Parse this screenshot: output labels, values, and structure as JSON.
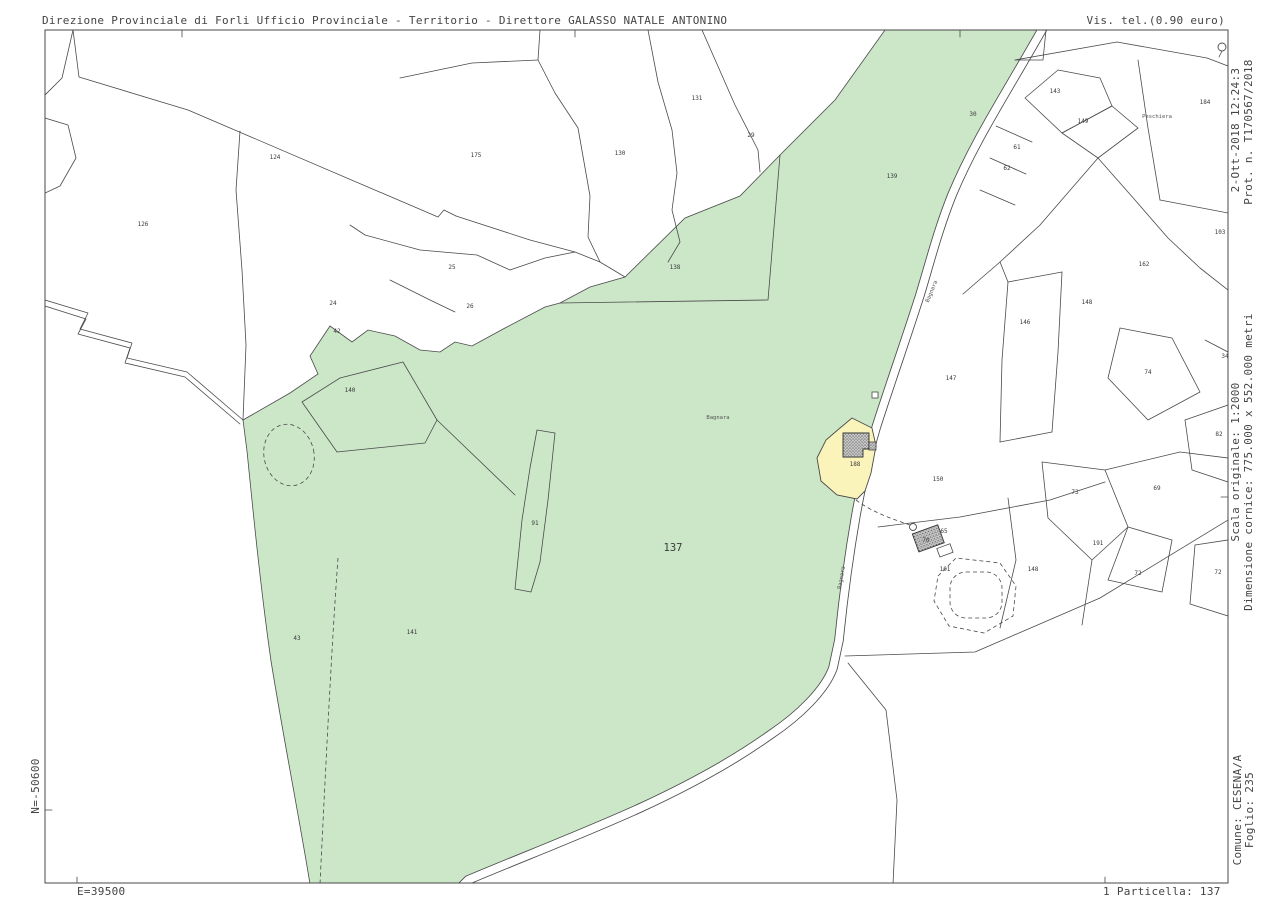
{
  "header": {
    "left": "Direzione Provinciale di Forli  Ufficio Provinciale - Territorio - Direttore GALASSO NATALE ANTONINO",
    "right": "Vis. tel.(0.90 euro)"
  },
  "margins": {
    "right_top_date": "2-Ott-2018 12:24:3",
    "right_top_protocol": "Prot. n. T170567/2018",
    "right_middle_scale": "Scala originale: 1:2000",
    "right_middle_frame": "Dimensione cornice: 775.000 x 552.000 metri",
    "right_bottom_comune": "Comune: CESENA/A",
    "right_bottom_foglio": "Foglio: 235",
    "left_north": "N=-50600",
    "bottom_east": "E=39500",
    "bottom_particella": "1 Particella: 137"
  },
  "map": {
    "selected_parcel": "137",
    "colors": {
      "selected_parcel_green": "#cbe7c8",
      "secondary_parcel_yellow": "#faf4bb",
      "boundary_line": "#4a4a4a",
      "building_fill": "#bdbdbd"
    },
    "labels": [
      {
        "t": "124",
        "x": 275,
        "y": 159
      },
      {
        "t": "126",
        "x": 143,
        "y": 226
      },
      {
        "t": "175",
        "x": 476,
        "y": 157
      },
      {
        "t": "130",
        "x": 620,
        "y": 155
      },
      {
        "t": "131",
        "x": 697,
        "y": 100
      },
      {
        "t": "29",
        "x": 751,
        "y": 137
      },
      {
        "t": "139",
        "x": 892,
        "y": 178
      },
      {
        "t": "138",
        "x": 675,
        "y": 269
      },
      {
        "t": "25",
        "x": 452,
        "y": 269
      },
      {
        "t": "26",
        "x": 470,
        "y": 308
      },
      {
        "t": "24",
        "x": 333,
        "y": 305
      },
      {
        "t": "42",
        "x": 337,
        "y": 333
      },
      {
        "t": "140",
        "x": 350,
        "y": 392
      },
      {
        "t": "30",
        "x": 973,
        "y": 116
      },
      {
        "t": "143",
        "x": 1055,
        "y": 93
      },
      {
        "t": "149",
        "x": 1083,
        "y": 123
      },
      {
        "t": "184",
        "x": 1205,
        "y": 104
      },
      {
        "t": "61",
        "x": 1017,
        "y": 149
      },
      {
        "t": "62",
        "x": 1007,
        "y": 170
      },
      {
        "t": "103",
        "x": 1220,
        "y": 234
      },
      {
        "t": "162",
        "x": 1144,
        "y": 266
      },
      {
        "t": "148",
        "x": 1087,
        "y": 304
      },
      {
        "t": "146",
        "x": 1025,
        "y": 324
      },
      {
        "t": "147",
        "x": 951,
        "y": 380
      },
      {
        "t": "74",
        "x": 1148,
        "y": 374
      },
      {
        "t": "34",
        "x": 1225,
        "y": 358
      },
      {
        "t": "82",
        "x": 1219,
        "y": 436
      },
      {
        "t": "150",
        "x": 938,
        "y": 481
      },
      {
        "t": "73",
        "x": 1075,
        "y": 494
      },
      {
        "t": "69",
        "x": 1157,
        "y": 490
      },
      {
        "t": "65",
        "x": 944,
        "y": 533
      },
      {
        "t": "70",
        "x": 926,
        "y": 542
      },
      {
        "t": "191",
        "x": 1098,
        "y": 545
      },
      {
        "t": "148",
        "x": 1033,
        "y": 571
      },
      {
        "t": "101",
        "x": 945,
        "y": 571
      },
      {
        "t": "72",
        "x": 1138,
        "y": 575
      },
      {
        "t": "72",
        "x": 1218,
        "y": 574
      },
      {
        "t": "188",
        "x": 855,
        "y": 466
      },
      {
        "t": "43",
        "x": 297,
        "y": 640
      },
      {
        "t": "141",
        "x": 412,
        "y": 634
      },
      {
        "t": "91",
        "x": 535,
        "y": 525
      },
      {
        "t": "137",
        "x": 673,
        "y": 551,
        "size": 10.5,
        "type": "parcel-selected"
      },
      {
        "t": "Bagnara",
        "x": 718,
        "y": 419,
        "size": 5.5,
        "type": "locality"
      },
      {
        "t": "Peschiera",
        "x": 1157,
        "y": 118,
        "size": 5.5,
        "type": "locality"
      },
      {
        "t": "Bagnara",
        "x": 933,
        "y": 292,
        "size": 5.5,
        "rot": -68,
        "type": "road"
      },
      {
        "t": "Bagnara",
        "x": 843,
        "y": 578,
        "size": 5.5,
        "rot": -80,
        "type": "road"
      }
    ]
  }
}
